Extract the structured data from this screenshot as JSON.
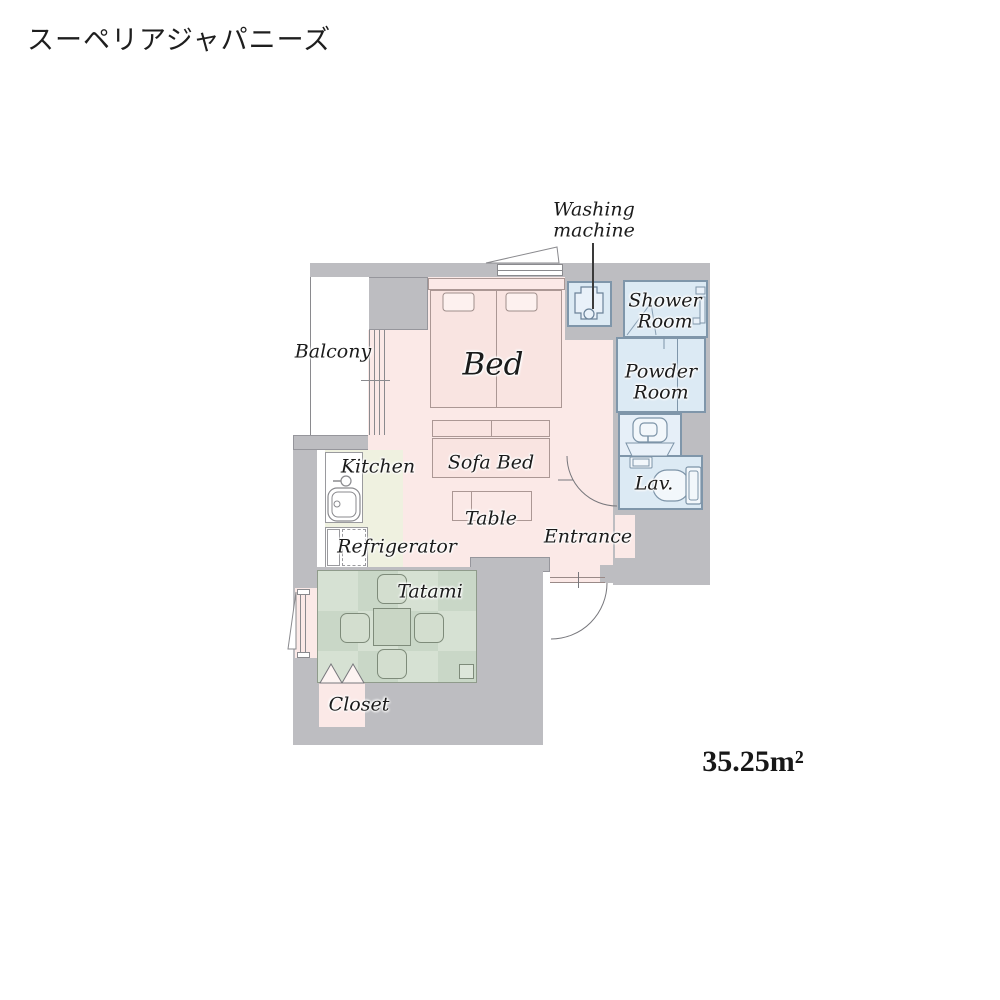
{
  "title": "スーペリアジャパニーズ",
  "area": "35.25m²",
  "labels": {
    "balcony": "Balcony",
    "bed": "Bed",
    "washing_machine": "Washing\nmachine",
    "shower_room": "Shower\nRoom",
    "powder_room": "Powder\nRoom",
    "lav": "Lav.",
    "kitchen": "Kitchen",
    "refrigerator": "Refrigerator",
    "sofa_bed": "Sofa Bed",
    "table": "Table",
    "entrance": "Entrance",
    "tatami": "Tatami",
    "closet": "Closet"
  },
  "colors": {
    "wall": "#bdbdc1",
    "room_pink": "#fbe9e7",
    "wet_blue": "#dceaf4",
    "kitchen_cream": "#eff1e0",
    "tatami_green_light": "#d6e1d3",
    "tatami_green_dark": "#c9d7c7",
    "balcony_white": "#ffffff"
  },
  "icons": [
    "washing-machine-icon",
    "shower-icon",
    "washbasin-icon",
    "toilet-icon",
    "kitchen-sink-icon",
    "faucet-icon",
    "refrigerator-icon",
    "bed-pillow-icon",
    "door-swing-arc",
    "window-flap-icon",
    "closet-door-icon",
    "tatami-table-icon",
    "floor-cushion-icon",
    "sliding-door-icon"
  ]
}
